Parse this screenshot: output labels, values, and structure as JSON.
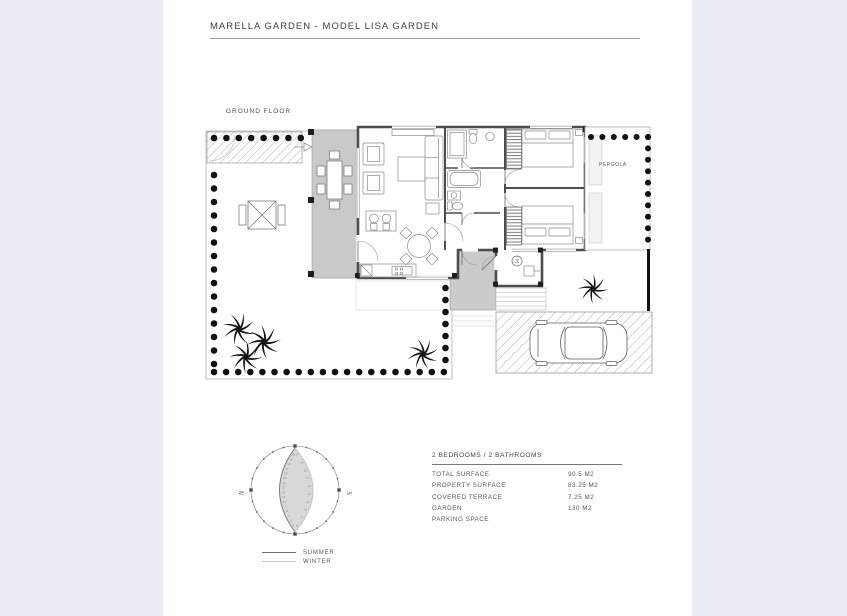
{
  "page": {
    "title": "MARELLA GARDEN - MODEL LISA GARDEN"
  },
  "floorplan": {
    "label": "GROUND FLOOR",
    "pergola_label": "PERGOLA",
    "utility_symbol": "H"
  },
  "compass": {
    "north": "N",
    "south": "S",
    "summer_hours": [
      "20",
      "19",
      "18",
      "17",
      "16",
      "15",
      "14",
      "13",
      "12",
      "11",
      "10",
      "9",
      "8",
      "7",
      "6",
      "5"
    ],
    "winter_hours": [
      "17",
      "16",
      "15",
      "14",
      "13",
      "12",
      "11",
      "10",
      "9",
      "8"
    ],
    "legend_summer": "SUMMER",
    "legend_winter": "WINTER"
  },
  "details": {
    "header": "2 BEDROOMS / 2 BATHROOMS",
    "rows": [
      {
        "label": "TOTAL SURFACE",
        "value": "90.5 M2"
      },
      {
        "label": "PROPERTY SURFACE",
        "value": "83.25 M2"
      },
      {
        "label": "COVERED TERRACE",
        "value": "7.25 M2"
      },
      {
        "label": "GARDEN",
        "value": "130 M2"
      },
      {
        "label": "PARKING SPACE",
        "value": ""
      }
    ]
  }
}
